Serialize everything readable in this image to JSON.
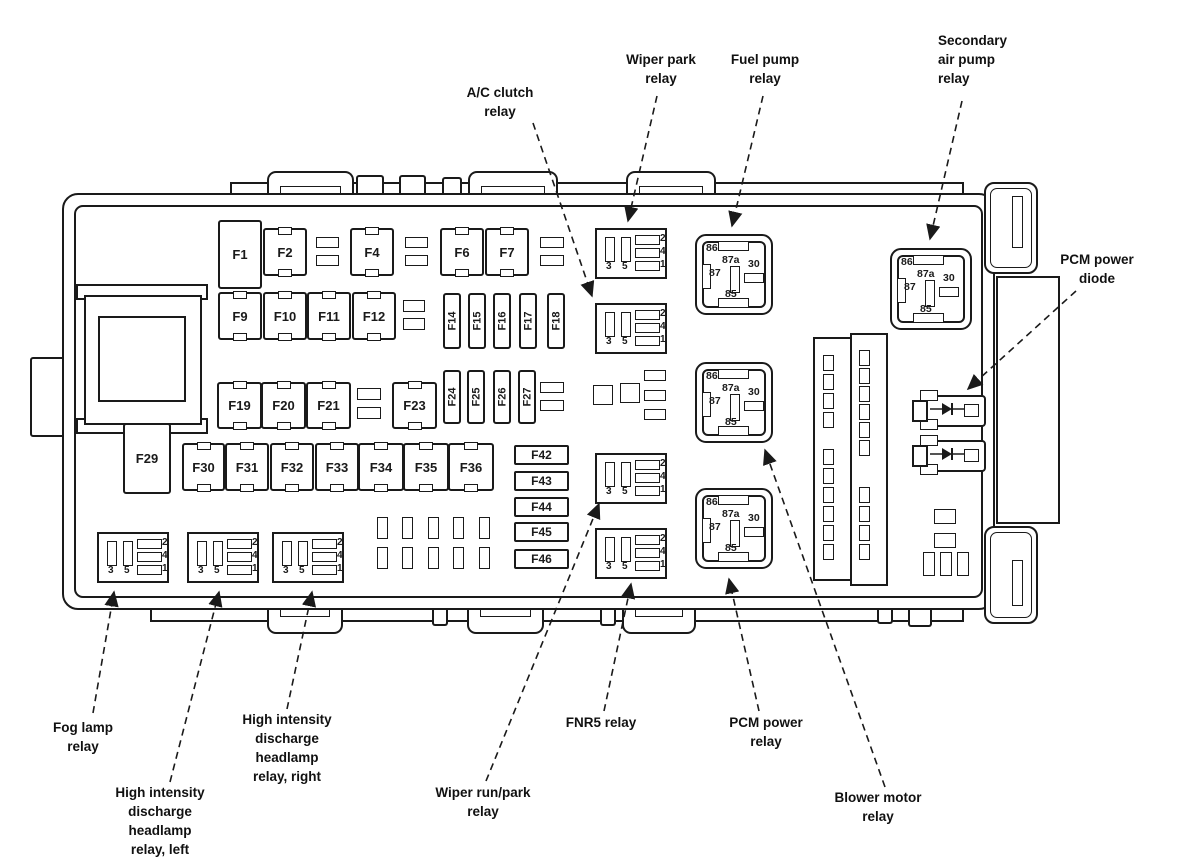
{
  "title": "Fuse box diagram",
  "callouts": {
    "ac_clutch": {
      "text": "A/C clutch\nrelay"
    },
    "wiper_park": {
      "text": "Wiper park\nrelay"
    },
    "fuel_pump": {
      "text": "Fuel pump\nrelay"
    },
    "secondary_air": {
      "text": "Secondary\nair pump\nrelay"
    },
    "pcm_diode": {
      "text": "PCM power\ndiode"
    },
    "fog_lamp": {
      "text": "Fog lamp\nrelay"
    },
    "hid_left": {
      "text": "High intensity\ndischarge\nheadlamp\nrelay, left"
    },
    "hid_right": {
      "text": "High intensity\ndischarge\nheadlamp\nrelay, right"
    },
    "wiper_run_park": {
      "text": "Wiper run/park\nrelay"
    },
    "fnr5": {
      "text": "FNR5 relay"
    },
    "pcm_power": {
      "text": "PCM power\nrelay"
    },
    "blower": {
      "text": "Blower motor\nrelay"
    }
  },
  "fuses": {
    "standard": [
      "F1",
      "F2",
      "F4",
      "F6",
      "F7",
      "F9",
      "F10",
      "F11",
      "F12",
      "F19",
      "F20",
      "F21",
      "F23",
      "F29",
      "F30",
      "F31",
      "F32",
      "F33",
      "F34",
      "F35",
      "F36"
    ],
    "vertical": [
      "F14",
      "F15",
      "F16",
      "F17",
      "F18",
      "F24",
      "F25",
      "F26",
      "F27"
    ],
    "mini": [
      "F42",
      "F43",
      "F44",
      "F45",
      "F46"
    ]
  },
  "relay_pins": [
    "86",
    "87a",
    "87",
    "30",
    "85"
  ],
  "socket_pins": {
    "bottom": [
      "3",
      "5"
    ],
    "side": [
      "2",
      "4",
      "1"
    ]
  },
  "colors": {
    "line": "#1a1a1a",
    "background": "#ffffff"
  }
}
